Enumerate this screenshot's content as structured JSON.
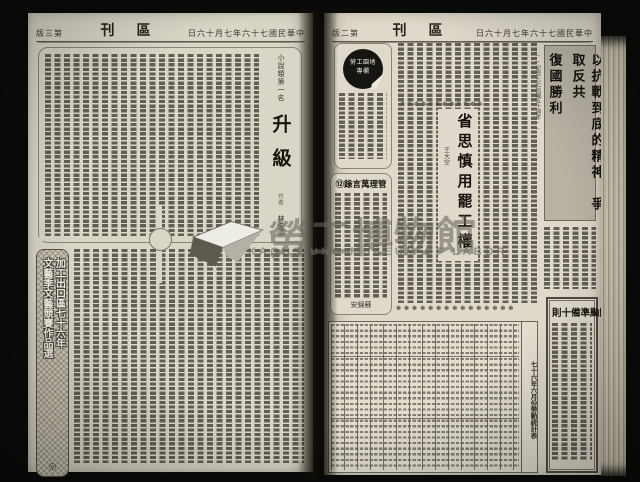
{
  "watermark": {
    "cjk_title": "勞工博物館",
    "latin_title": "KAOHSIUNG MUSEUM OF LABOR"
  },
  "left_page": {
    "edition_display": "版三第",
    "masthead_display": "刊區",
    "date_display": "日六十月七年六十七國民華中",
    "story": {
      "kicker": "小說類第一名",
      "title": "升級",
      "byline_label": "作者",
      "byline": "林俊德"
    },
    "banner": {
      "col_right": "加工出口區七十六年",
      "col_left": "文藝季文藝競賽作品選",
      "seal": "◎"
    }
  },
  "right_page": {
    "edition_display": "版二第",
    "masthead_display": "刊區",
    "date_display": "日六十月七年六十七國民華中",
    "lead_headline": {
      "col_main": "以抗戰到底的精神　爭取反共",
      "col_sub": "復國勝利",
      "kicker": "──紀念七七抗戰五十週年──"
    },
    "badge": {
      "line1": "勞工園地",
      "line2": "專欄"
    },
    "essay": {
      "title": "省思慎用罷工權",
      "byline": "王大空",
      "ornament_row": "✽✽✽✽✽✽✽✽✽✽✽✽"
    },
    "quotes": {
      "header_display": "⑫錄言萬理管",
      "signature_display": "安錦蘇"
    },
    "stats": {
      "ornament_row": "✽✽✽✽✽✽✽✽✽✽✽✽✽✽✽",
      "caption": "七十六年六月份勞動統計表"
    },
    "typhoon": {
      "title_display": "則十備準颱防"
    }
  }
}
